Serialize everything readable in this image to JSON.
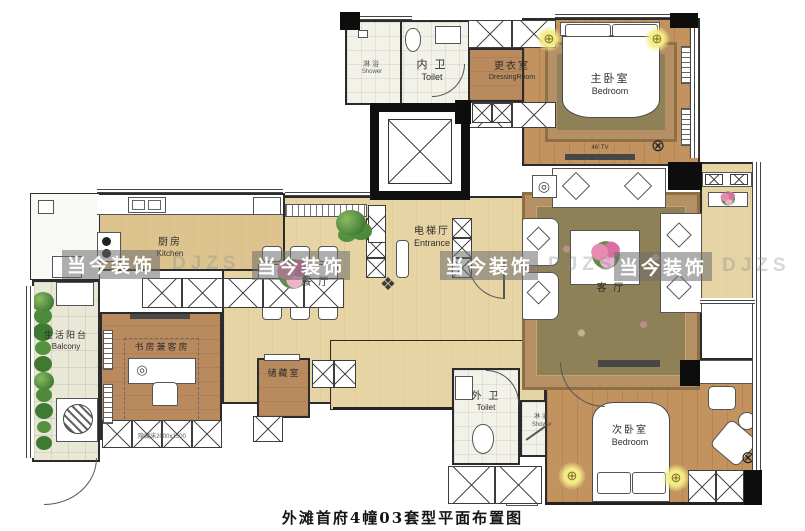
{
  "title": "外滩首府4幢03套型平面布置图",
  "watermark": {
    "text": "当今装饰",
    "ghost": "DJZS"
  },
  "icons": {
    "ceiling_light": "⊕",
    "fan_coil": "⊗",
    "entry_decor": "❖",
    "round_decor": "◎"
  },
  "annotations": {
    "master_tv": "46' TV",
    "study_hidden_bed": "隐藏床2000x1500"
  },
  "rooms": {
    "shower_top": {
      "zh": "淋浴",
      "en": "Shower"
    },
    "toilet_inner": {
      "zh": "内 卫",
      "en": "Toilet"
    },
    "dressing": {
      "zh": "更衣室",
      "en": "DressingRoom"
    },
    "master_bedroom": {
      "zh": "主卧室",
      "en": "Bedroom"
    },
    "entrance": {
      "zh": "电梯厅",
      "en": "Entrance"
    },
    "kitchen": {
      "zh": "厨房",
      "en": "Kitchen"
    },
    "dining": {
      "zh": "餐 厅",
      "en": ""
    },
    "living": {
      "zh": "客 厅",
      "en": ""
    },
    "balcony": {
      "zh": "生活阳台",
      "en": "Balcony"
    },
    "study": {
      "zh": "书房兼客房",
      "en": ""
    },
    "storage": {
      "zh": "储藏室",
      "en": ""
    },
    "toilet_outer": {
      "zh": "外 卫",
      "en": "Toilet"
    },
    "shower_bottom": {
      "zh": "淋浴",
      "en": "Shower"
    },
    "second_bedroom": {
      "zh": "次卧室",
      "en": "Bedroom"
    }
  }
}
